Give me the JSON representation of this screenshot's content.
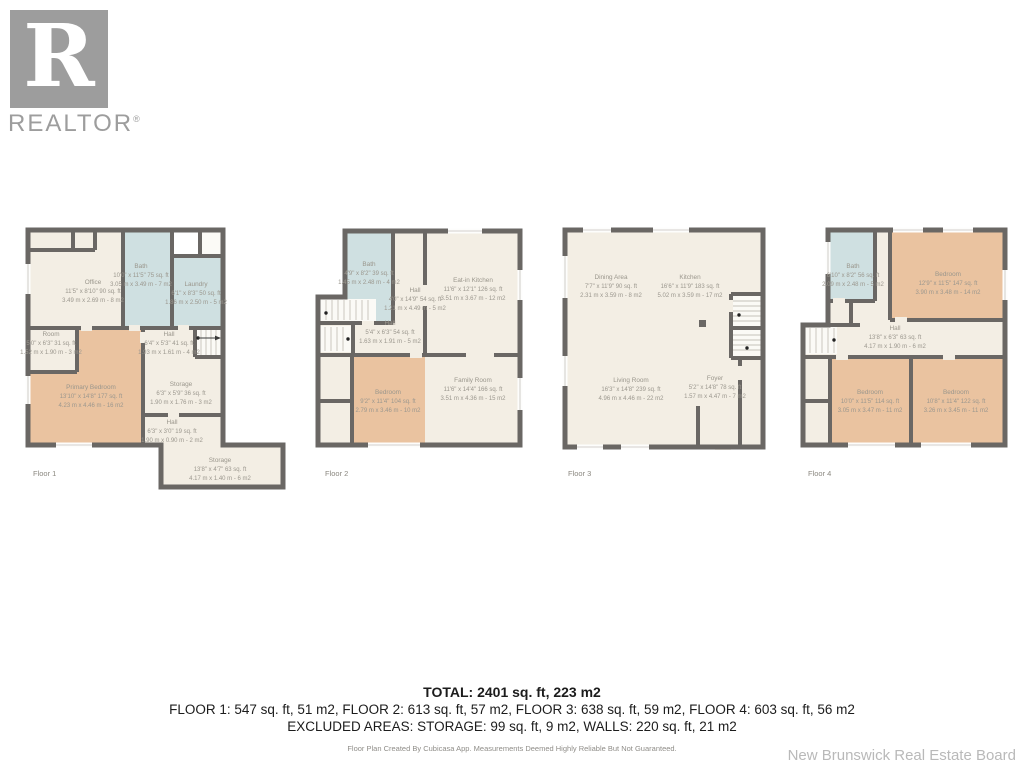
{
  "brand": {
    "logo_letter": "R",
    "logo_text": "REALTOR",
    "registered": "®"
  },
  "colors": {
    "wall": "#6a6764",
    "room": "#f3eee4",
    "wet_room": "#cfe0e1",
    "bedroom": "#eac3a0",
    "label_text": "#9a968c"
  },
  "floors": [
    {
      "label": "Floor 1",
      "rooms": [
        {
          "name": "Office",
          "ft": "11'5\" x 8'10\" 90 sq. ft",
          "m": "3.49 m x 2.69 m - 8 m2"
        },
        {
          "name": "Bath",
          "ft": "10'0\" x 11'5\" 75 sq. ft",
          "m": "3.05 m x 3.49 m - 7 m2"
        },
        {
          "name": "Laundry",
          "ft": "6'1\" x 8'3\" 50 sq. ft",
          "m": "1.86 m x 2.50 m - 5 m2"
        },
        {
          "name": "Room",
          "ft": "5'0\" x 6'3\" 31 sq. ft",
          "m": "1.52 m x 1.90 m - 3 m2"
        },
        {
          "name": "Hall",
          "ft": "6'4\" x 5'3\" 41 sq. ft",
          "m": "1.93 m x 1.61 m - 4 m2"
        },
        {
          "name": "Primary Bedroom",
          "ft": "13'10\" x 14'8\" 177 sq. ft",
          "m": "4.23 m x 4.46 m - 16 m2"
        },
        {
          "name": "Storage",
          "ft": "6'3\" x 5'9\" 36 sq. ft",
          "m": "1.90 m x 1.76 m - 3 m2"
        },
        {
          "name": "Hall",
          "ft": "6'3\" x 3'0\" 19 sq. ft",
          "m": "1.90 m x 0.90 m - 2 m2"
        },
        {
          "name": "Storage",
          "ft": "13'8\" x 4'7\" 63 sq. ft",
          "m": "4.17 m x 1.40 m - 6 m2"
        }
      ]
    },
    {
      "label": "Floor 2",
      "rooms": [
        {
          "name": "Bath",
          "ft": "4'9\" x 8'2\" 39 sq. ft",
          "m": "1.45 m x 2.48 m - 4 m2"
        },
        {
          "name": "Hall",
          "ft": "4'0\" x 14'9\" 54 sq. ft",
          "m": "1.21 m x 4.49 m - 5 m2"
        },
        {
          "name": "Eat-in Kitchen",
          "ft": "11'6\" x 12'1\" 126 sq. ft",
          "m": "3.51 m x 3.67 m - 12 m2"
        },
        {
          "name": "Hall",
          "ft": "5'4\" x 6'3\" 54 sq. ft",
          "m": "1.63 m x 1.91 m - 5 m2"
        },
        {
          "name": "Bedroom",
          "ft": "9'2\" x 11'4\" 104 sq. ft",
          "m": "2.79 m x 3.46 m - 10 m2"
        },
        {
          "name": "Family Room",
          "ft": "11'6\" x 14'4\" 166 sq. ft",
          "m": "3.51 m x 4.36 m - 15 m2"
        }
      ]
    },
    {
      "label": "Floor 3",
      "rooms": [
        {
          "name": "Dining Area",
          "ft": "7'7\" x 11'9\" 90 sq. ft",
          "m": "2.31 m x 3.59 m - 8 m2"
        },
        {
          "name": "Kitchen",
          "ft": "16'6\" x 11'9\" 183 sq. ft",
          "m": "5.02 m x 3.59 m - 17 m2"
        },
        {
          "name": "Living Room",
          "ft": "16'3\" x 14'8\" 239 sq. ft",
          "m": "4.96 m x 4.46 m - 22 m2"
        },
        {
          "name": "Foyer",
          "ft": "5'2\" x 14'8\" 78 sq. ft",
          "m": "1.57 m x 4.47 m - 7 m2"
        }
      ]
    },
    {
      "label": "Floor 4",
      "rooms": [
        {
          "name": "Bath",
          "ft": "6'10\" x 8'2\" 56 sq. ft",
          "m": "2.09 m x 2.48 m - 5 m2"
        },
        {
          "name": "Bedroom",
          "ft": "12'9\" x 11'5\" 147 sq. ft",
          "m": "3.90 m x 3.48 m - 14 m2"
        },
        {
          "name": "Hall",
          "ft": "13'8\" x 6'3\" 63 sq. ft",
          "m": "4.17 m x 1.90 m - 6 m2"
        },
        {
          "name": "Bedroom",
          "ft": "10'0\" x 11'5\" 114 sq. ft",
          "m": "3.05 m x 3.47 m - 11 m2"
        },
        {
          "name": "Bedroom",
          "ft": "10'8\" x 11'4\" 122 sq. ft",
          "m": "3.26 m x 3.45 m - 11 m2"
        }
      ]
    }
  ],
  "summary": {
    "total": "TOTAL: 2401 sq. ft, 223 m2",
    "floors_line": "FLOOR 1: 547 sq. ft, 51 m2, FLOOR 2: 613 sq. ft, 57 m2, FLOOR 3: 638 sq. ft, 59 m2, FLOOR 4: 603 sq. ft, 56 m2",
    "excluded_line": "EXCLUDED AREAS: STORAGE: 99 sq. ft, 9 m2, WALLS: 220 sq. ft, 21 m2",
    "disclaimer": "Floor Plan Created By Cubicasa App. Measurements Deemed Highly Reliable But Not Guaranteed."
  },
  "footer": {
    "board_name": "New Brunswick Real Estate Board"
  }
}
